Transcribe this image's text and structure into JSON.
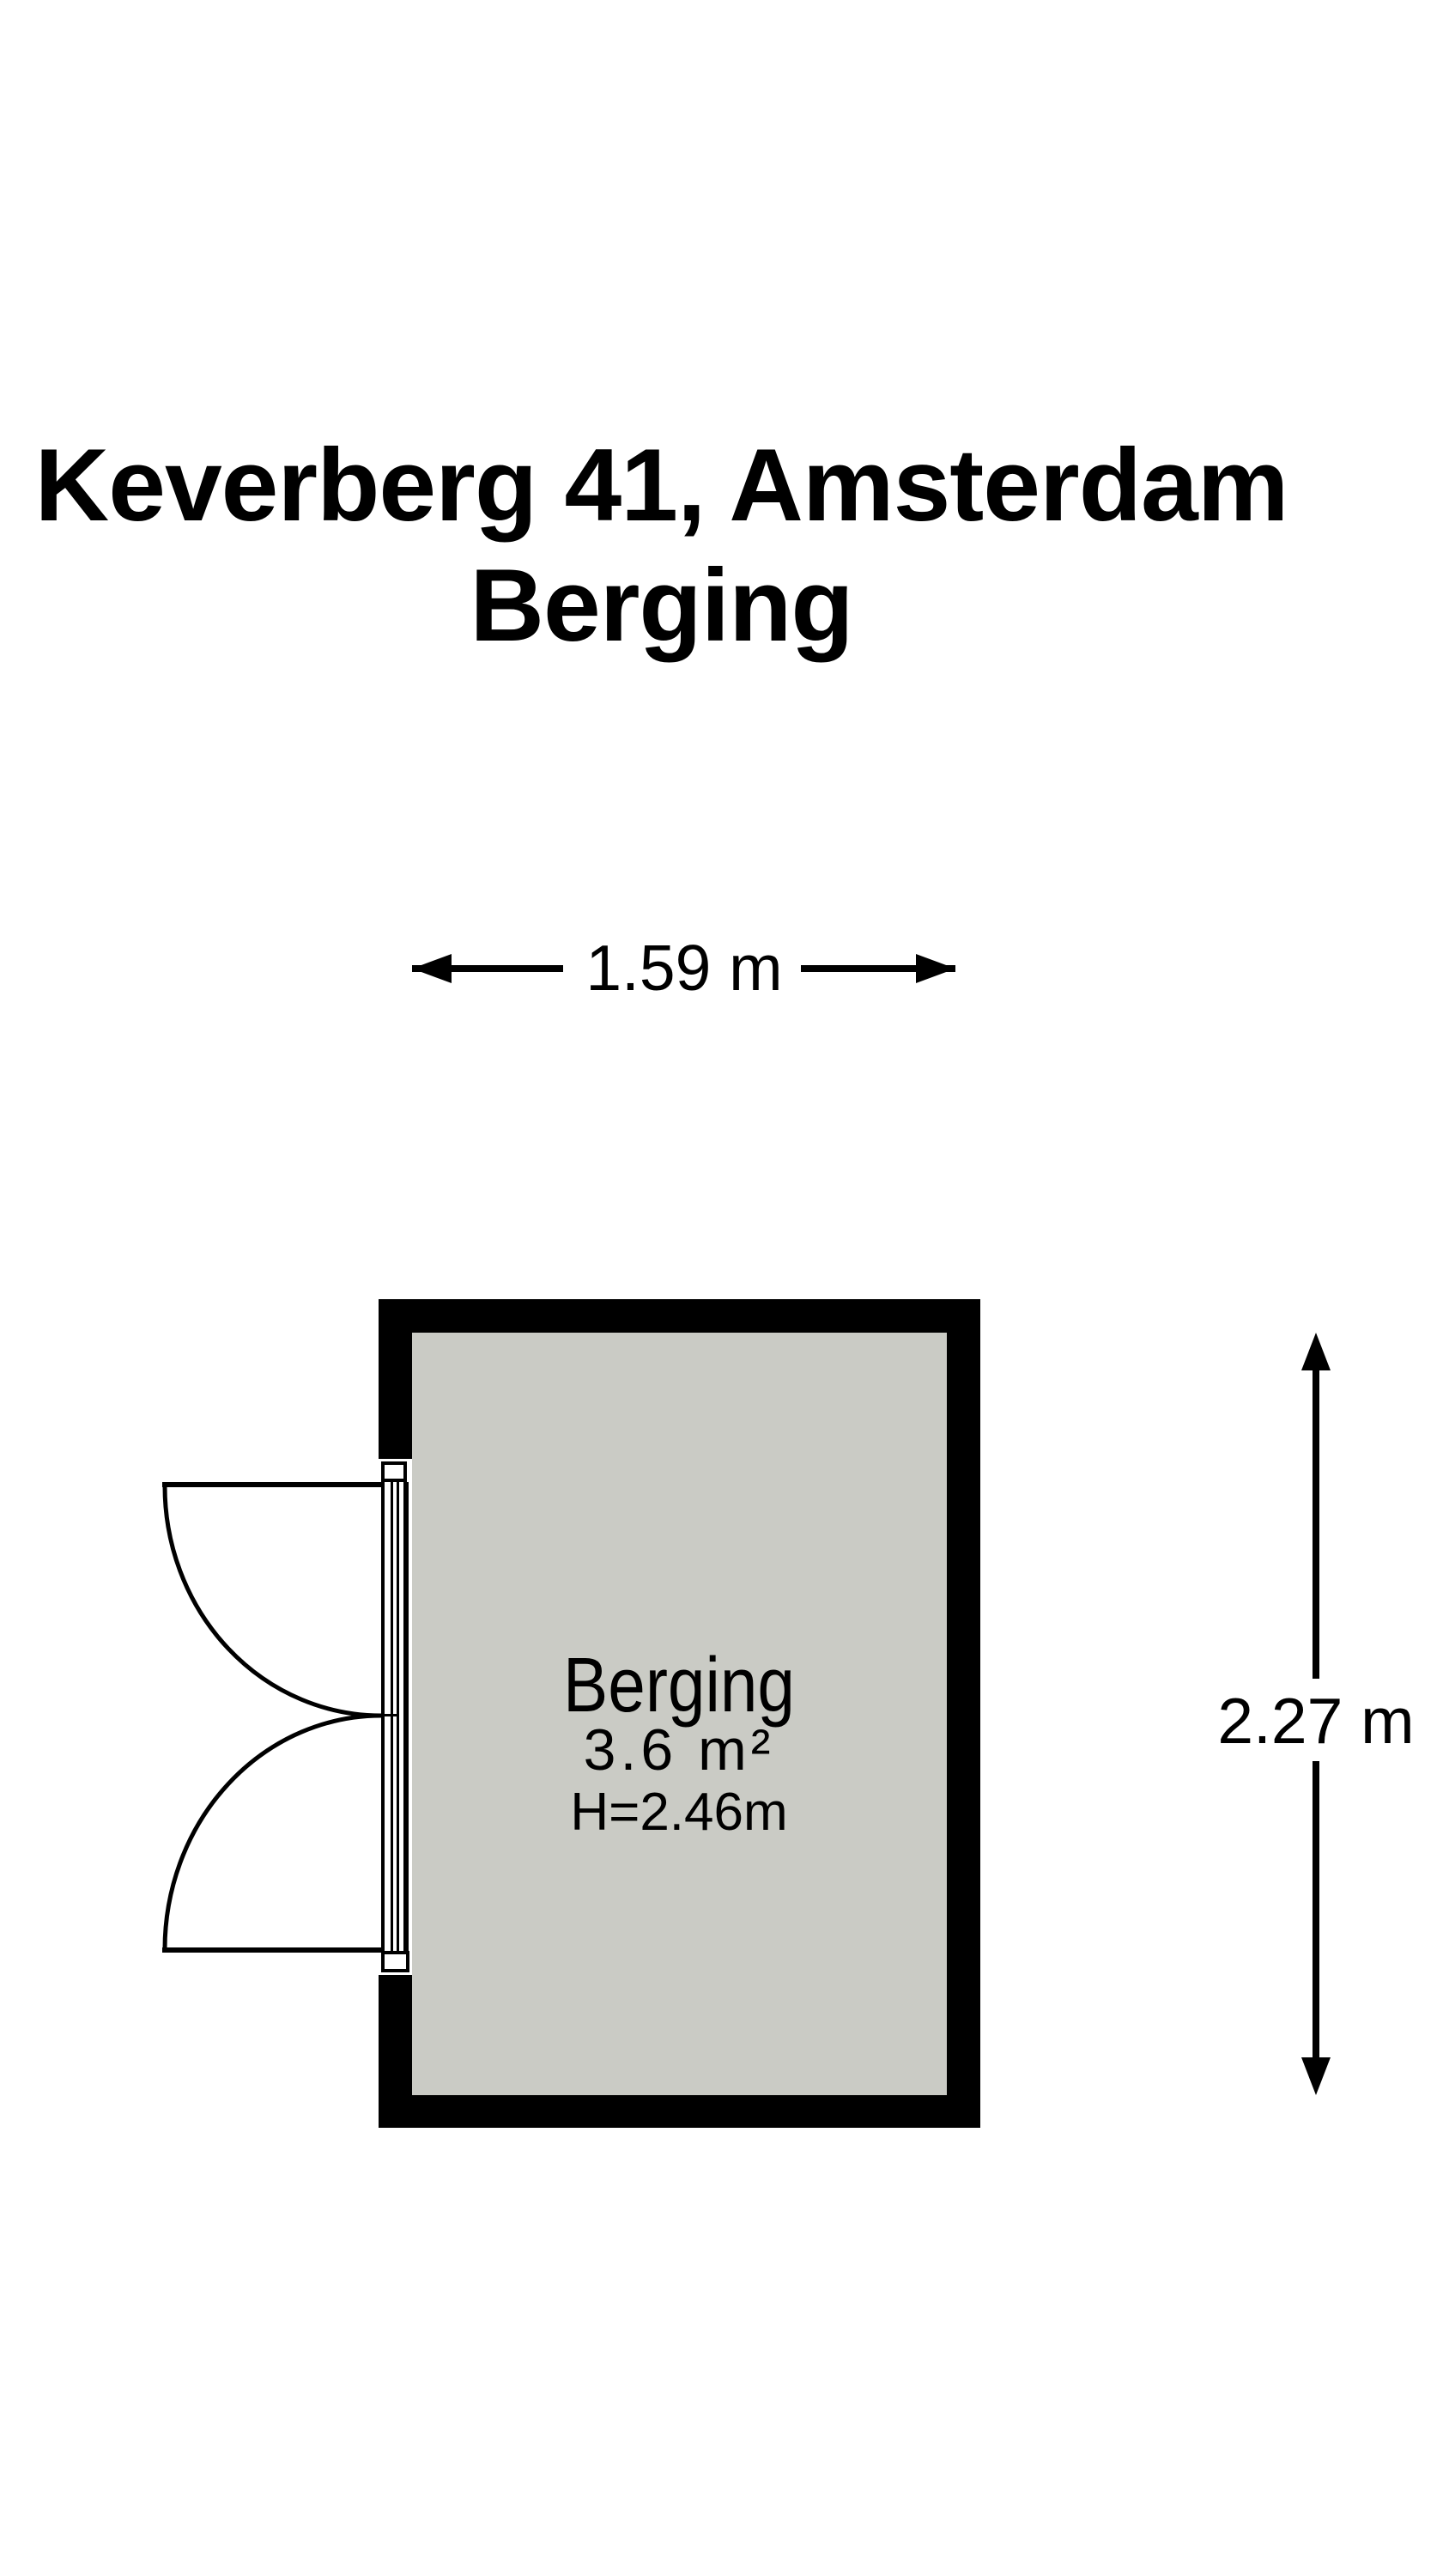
{
  "title": {
    "line1": "Keverberg 41, Amsterdam",
    "line2": "Berging"
  },
  "dimensions": {
    "width_label": "1.59 m",
    "height_label": "2.27 m"
  },
  "room": {
    "name": "Berging",
    "area": "3.6 m²",
    "height": "H=2.46m"
  },
  "icons": {
    "arrow_left": "left-pointing dimension arrowhead (css triangle)",
    "arrow_right": "right-pointing dimension arrowhead (css triangle)",
    "arrow_up": "up-pointing dimension arrowhead (css triangle)",
    "arrow_down": "down-pointing dimension arrowhead (css triangle)"
  },
  "colors": {
    "background": "#ffffff",
    "wall": "#000000",
    "floor": "#cacbc5",
    "line": "#000000",
    "text": "#000000"
  }
}
